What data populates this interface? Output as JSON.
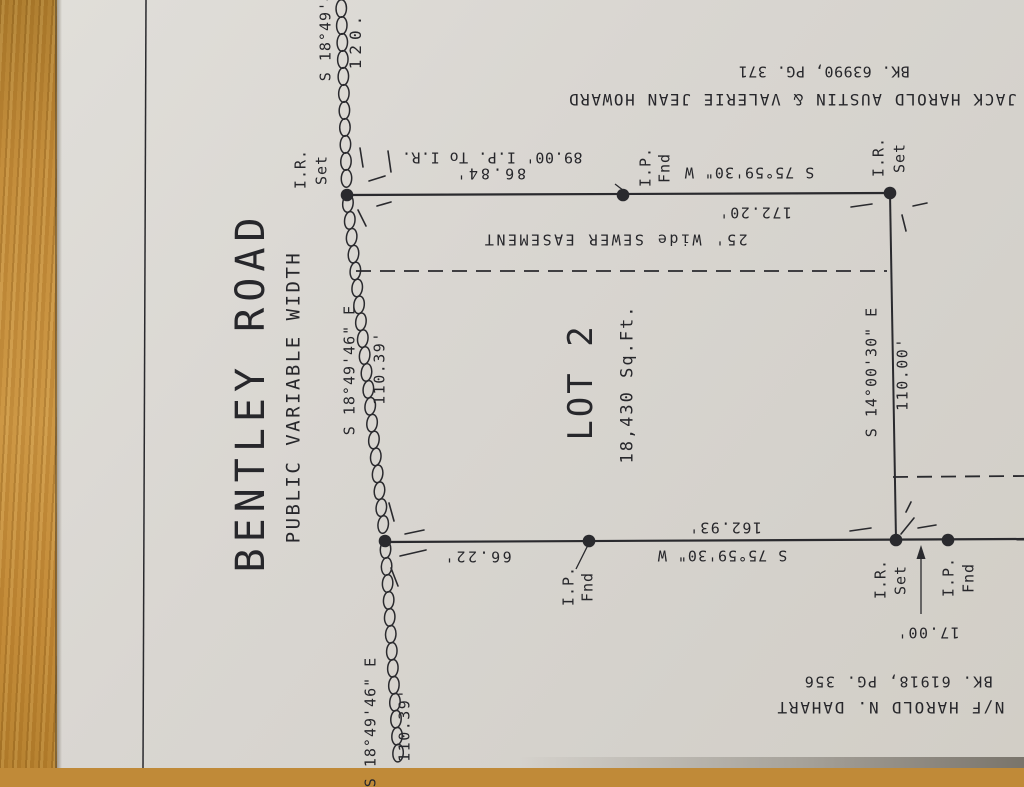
{
  "colors": {
    "ink": "#2a2a2e",
    "paper": "#d9d6d1",
    "wood": "#c08a38"
  },
  "plat": {
    "road": {
      "name": "BENTLEY ROAD",
      "type": "PUBLIC VARIABLE WIDTH"
    },
    "lot": {
      "title": "LOT 2",
      "area": "18,430 Sq.Ft."
    },
    "easement": {
      "label": "25' Wide SEWER EASEMENT"
    },
    "abutter_north": {
      "name": "JACK HAROLD AUSTIN & VALERIE JEAN HOWARD",
      "deed": "BK. 63990, PG. 371"
    },
    "abutter_south": {
      "name": "N/F HAROLD N. DAHART",
      "deed": "BK. 61918, PG. 356"
    },
    "north_line": {
      "bearing": "S 75°59'30\" W",
      "distance": "172.20'",
      "segment": "86.84'",
      "tie": "89.00' I.P. To I.R."
    },
    "east_line": {
      "bearing": "S 14°00'30\" E",
      "distance": "110.00'"
    },
    "south_line": {
      "bearing": "S 75°59'30\" W",
      "distance": "162.93'",
      "segment": "66.22'",
      "extension": "17.00'"
    },
    "road_frontage": {
      "bearing": "S 18°49'46\" E",
      "distance": "110.39'",
      "partial_top": "120."
    },
    "markers": [
      "I.R. Set",
      "I.P. Fnd"
    ]
  },
  "labels": [
    {
      "n": "road-name",
      "t": "BENTLEY ROAD",
      "x": 251,
      "y": 392,
      "r": -90,
      "s": 40,
      "ls": 6
    },
    {
      "n": "road-type",
      "t": "PUBLIC VARIABLE WIDTH",
      "x": 294,
      "y": 397,
      "r": -90,
      "s": 19,
      "ls": 2.5
    },
    {
      "n": "frontage-bearing-top-partial",
      "t": "S 18°49'46\" E",
      "x": 326,
      "y": 16,
      "r": -90,
      "s": 15,
      "ls": 1
    },
    {
      "n": "frontage-distance-top-partial",
      "t": "120.",
      "x": 356,
      "y": 40,
      "r": -90,
      "s": 16,
      "ls": 5
    },
    {
      "n": "marker-ir-nw",
      "t": "I.R.",
      "x": 301,
      "y": 169,
      "r": -90,
      "s": 15,
      "ls": 1
    },
    {
      "n": "marker-ir-nw-set",
      "t": "Set",
      "x": 322,
      "y": 170,
      "r": -90,
      "s": 15,
      "ls": 1
    },
    {
      "n": "north-tie-distance",
      "t": "89.00' I.P. To I.R.",
      "x": 492,
      "y": 157,
      "r": 180,
      "s": 15,
      "ls": 0.5
    },
    {
      "n": "north-segment-distance",
      "t": "86.84'",
      "x": 490,
      "y": 173,
      "r": 180,
      "s": 15,
      "ls": 3
    },
    {
      "n": "marker-ip-north",
      "t": "I.P.",
      "x": 646,
      "y": 167,
      "r": -90,
      "s": 15,
      "ls": 1
    },
    {
      "n": "marker-ip-north-fnd",
      "t": "Fnd",
      "x": 665,
      "y": 168,
      "r": -90,
      "s": 15,
      "ls": 1
    },
    {
      "n": "north-line-bearing",
      "t": "S 75°59'30\" W",
      "x": 749,
      "y": 172,
      "r": 180,
      "s": 15,
      "ls": 1
    },
    {
      "n": "north-line-distance",
      "t": "172.20'",
      "x": 755,
      "y": 212,
      "r": 180,
      "s": 15,
      "ls": 1.5
    },
    {
      "n": "marker-ir-ne",
      "t": "I.R.",
      "x": 879,
      "y": 157,
      "r": -90,
      "s": 15,
      "ls": 1
    },
    {
      "n": "marker-ir-ne-set",
      "t": "Set",
      "x": 900,
      "y": 158,
      "r": -90,
      "s": 15,
      "ls": 1
    },
    {
      "n": "abutter-north-name",
      "t": "JACK HAROLD AUSTIN & VALERIE JEAN HOWARD",
      "x": 792,
      "y": 99,
      "r": 180,
      "s": 16,
      "ls": 1.6
    },
    {
      "n": "abutter-north-deed",
      "t": "BK. 63990, PG. 371",
      "x": 824,
      "y": 71,
      "r": 180,
      "s": 15,
      "ls": 0.5
    },
    {
      "n": "sewer-easement-label",
      "t": "25' Wide SEWER EASEMENT",
      "x": 615,
      "y": 239,
      "r": 180,
      "s": 15,
      "ls": 2.5
    },
    {
      "n": "lot-title",
      "t": "LOT 2",
      "x": 581,
      "y": 382,
      "r": -90,
      "s": 34,
      "ls": 3
    },
    {
      "n": "lot-area",
      "t": "18,430 Sq.Ft.",
      "x": 628,
      "y": 384,
      "r": -90,
      "s": 17,
      "ls": 2
    },
    {
      "n": "frontage-bearing-upper",
      "t": "S 18°49'46\" E",
      "x": 350,
      "y": 370,
      "r": -90,
      "s": 15,
      "ls": 1
    },
    {
      "n": "frontage-distance-upper",
      "t": "110.39'",
      "x": 380,
      "y": 368,
      "r": -90,
      "s": 15,
      "ls": 1.5
    },
    {
      "n": "east-line-bearing",
      "t": "S 14°00'30\" E",
      "x": 872,
      "y": 372,
      "r": -90,
      "s": 15,
      "ls": 1
    },
    {
      "n": "east-line-distance",
      "t": "110.00'",
      "x": 903,
      "y": 374,
      "r": -90,
      "s": 15,
      "ls": 1.5
    },
    {
      "n": "south-segment-distance",
      "t": "66.22'",
      "x": 477,
      "y": 556,
      "r": 180,
      "s": 15,
      "ls": 2.5
    },
    {
      "n": "marker-ip-south",
      "t": "I.P.",
      "x": 569,
      "y": 586,
      "r": -90,
      "s": 15,
      "ls": 1
    },
    {
      "n": "marker-ip-south-fnd",
      "t": "Fnd",
      "x": 588,
      "y": 587,
      "r": -90,
      "s": 15,
      "ls": 1
    },
    {
      "n": "south-line-distance",
      "t": "162.93'",
      "x": 725,
      "y": 527,
      "r": 180,
      "s": 15,
      "ls": 1.5
    },
    {
      "n": "south-line-bearing",
      "t": "S 75°59'30\" W",
      "x": 722,
      "y": 555,
      "r": 180,
      "s": 15,
      "ls": 1
    },
    {
      "n": "marker-ir-se",
      "t": "I.R.",
      "x": 881,
      "y": 579,
      "r": -90,
      "s": 15,
      "ls": 1
    },
    {
      "n": "marker-ir-se-set",
      "t": "Set",
      "x": 901,
      "y": 580,
      "r": -90,
      "s": 15,
      "ls": 1
    },
    {
      "n": "marker-ip-se",
      "t": "I.P.",
      "x": 949,
      "y": 577,
      "r": -90,
      "s": 15,
      "ls": 1
    },
    {
      "n": "marker-ip-se-fnd",
      "t": "Fnd",
      "x": 969,
      "y": 578,
      "r": -90,
      "s": 15,
      "ls": 1
    },
    {
      "n": "south-extension-distance",
      "t": "17.00'",
      "x": 928,
      "y": 632,
      "r": 180,
      "s": 15,
      "ls": 1.5
    },
    {
      "n": "abutter-south-name",
      "t": "N/F HAROLD N. DAHART",
      "x": 890,
      "y": 707,
      "r": 180,
      "s": 16,
      "ls": 1.8
    },
    {
      "n": "abutter-south-deed",
      "t": "BK. 61918, PG. 356",
      "x": 898,
      "y": 681,
      "r": 180,
      "s": 15,
      "ls": 1.5
    },
    {
      "n": "frontage-bearing-lower",
      "t": "S 18°49'46\" E",
      "x": 371,
      "y": 722,
      "r": -90,
      "s": 15,
      "ls": 1
    },
    {
      "n": "frontage-distance-lower",
      "t": "110.39'",
      "x": 405,
      "y": 725,
      "r": -90,
      "s": 15,
      "ls": 1.5
    }
  ],
  "geometry": {
    "solid": [
      [
        146,
        0,
        143,
        768,
        1.5
      ],
      [
        347,
        195,
        890,
        193,
        2.2
      ],
      [
        890,
        193,
        896,
        540,
        2.0
      ],
      [
        385,
        542,
        1024,
        539,
        2.2
      ],
      [
        921,
        549,
        921,
        614,
        1.3
      ],
      [
        615,
        184,
        628,
        194,
        1.3
      ],
      [
        576,
        569,
        588,
        545,
        1.3
      ]
    ],
    "dashed": [
      [
        356,
        271,
        887,
        271
      ],
      [
        893,
        477,
        1024,
        476
      ]
    ],
    "ticks": [
      [
        360,
        148,
        363,
        167
      ],
      [
        388,
        151,
        391,
        172
      ],
      [
        369,
        181,
        385,
        176
      ],
      [
        358,
        210,
        366,
        226
      ],
      [
        377,
        206,
        391,
        202
      ],
      [
        851,
        207,
        872,
        204
      ],
      [
        913,
        206,
        927,
        203
      ],
      [
        902,
        215,
        906,
        231
      ],
      [
        389,
        503,
        394,
        521
      ],
      [
        405,
        534,
        424,
        530
      ],
      [
        400,
        556,
        426,
        550
      ],
      [
        391,
        568,
        398,
        586
      ],
      [
        850,
        531,
        871,
        528
      ],
      [
        906,
        512,
        911,
        502
      ],
      [
        918,
        528,
        936,
        525
      ],
      [
        914,
        518,
        901,
        534
      ]
    ],
    "dots": [
      [
        347,
        195
      ],
      [
        623,
        195
      ],
      [
        890,
        193
      ],
      [
        385,
        541
      ],
      [
        589,
        541
      ],
      [
        896,
        540
      ],
      [
        948,
        540
      ]
    ],
    "arrow": [
      921,
      545
    ],
    "chain": [
      [
        341,
        0
      ],
      [
        347,
        195
      ],
      [
        385,
        541
      ],
      [
        399,
        768
      ]
    ]
  }
}
